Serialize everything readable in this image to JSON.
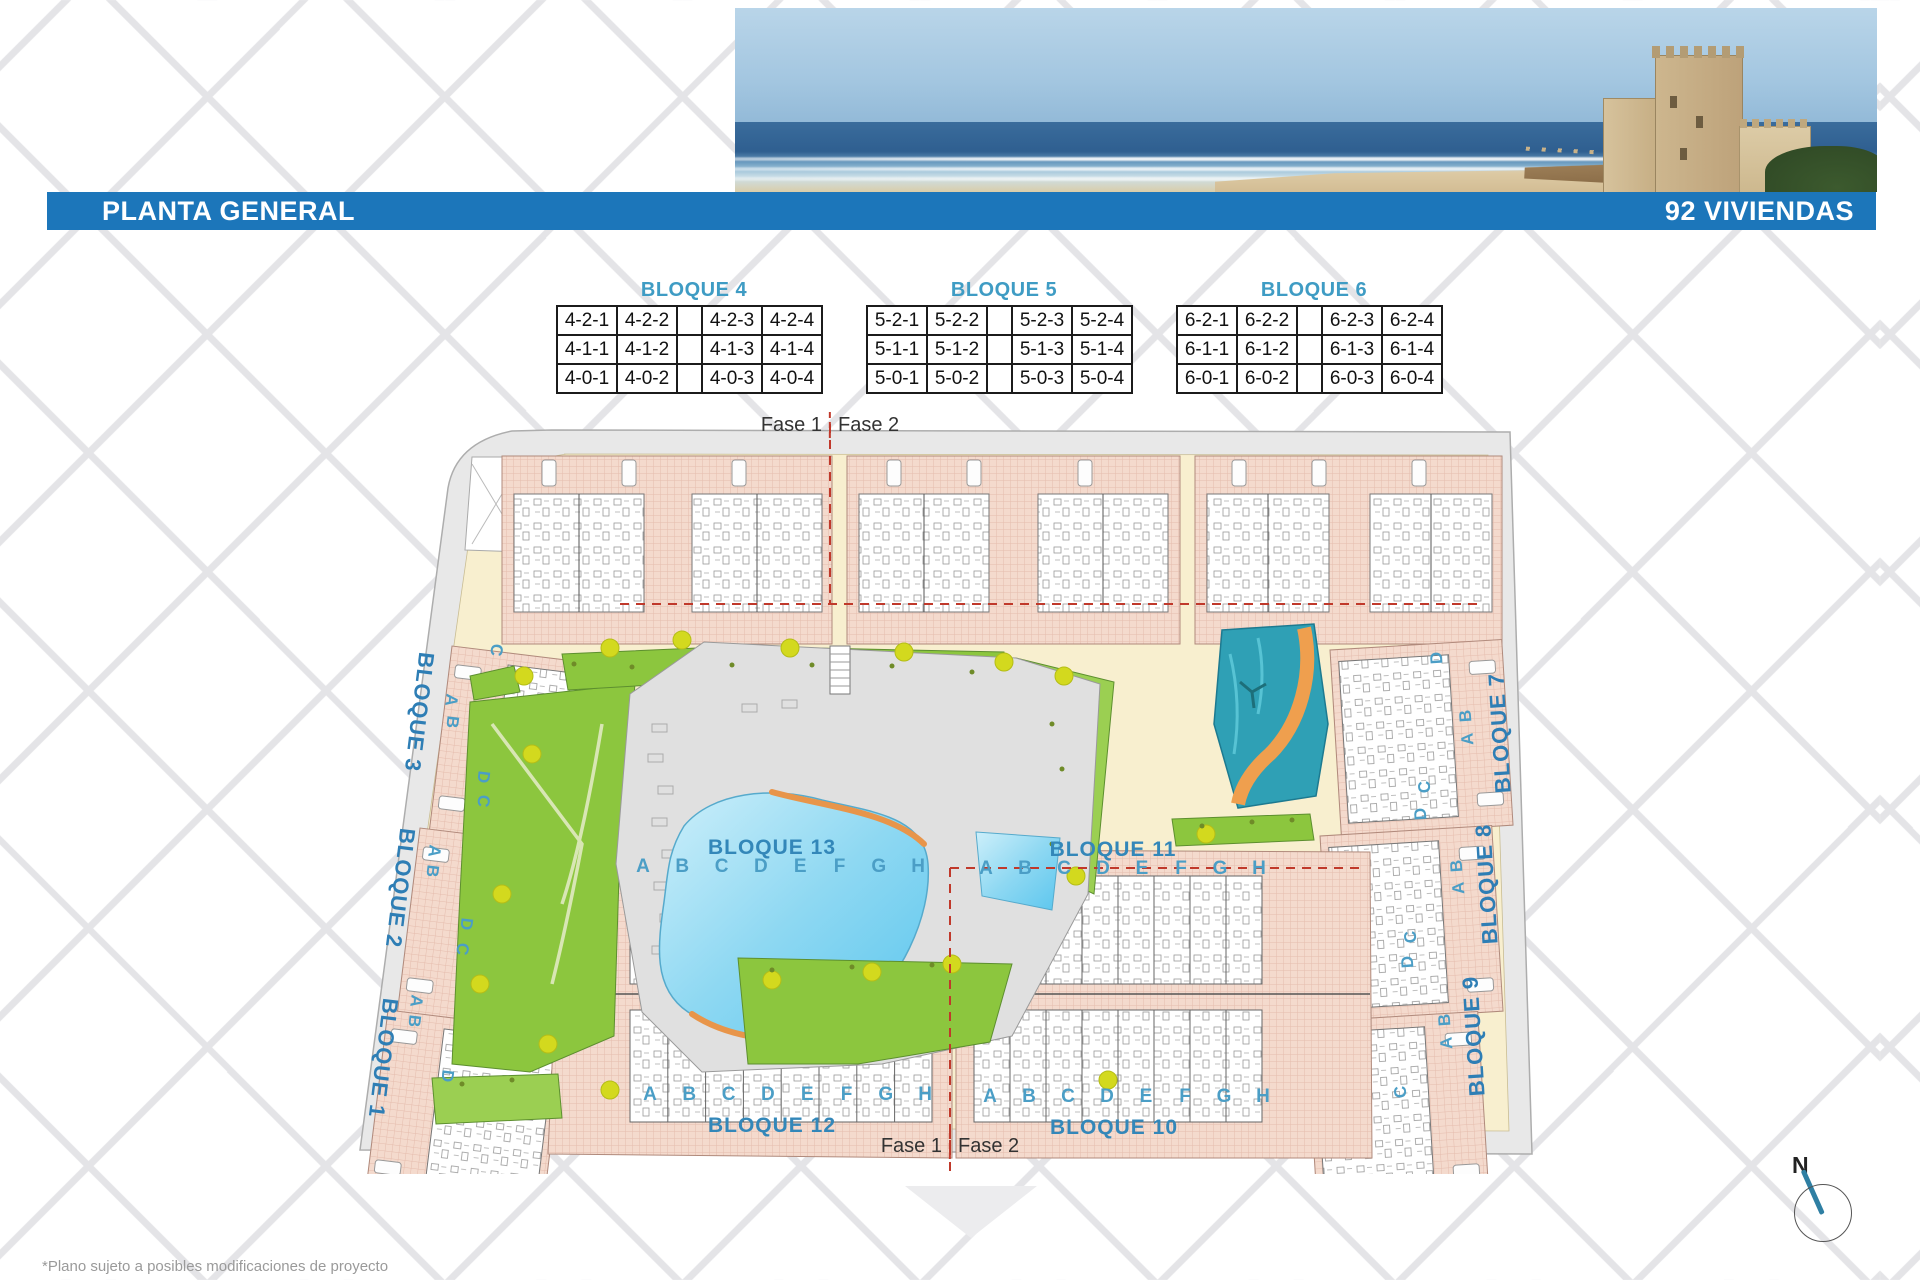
{
  "banner": {
    "title": "PLANTA GENERAL",
    "right": "92 VIVIENDAS"
  },
  "unit_tables": [
    {
      "title": "BLOQUE 4",
      "rows": [
        [
          "4-2-1",
          "4-2-2",
          "4-2-3",
          "4-2-4"
        ],
        [
          "4-1-1",
          "4-1-2",
          "4-1-3",
          "4-1-4"
        ],
        [
          "4-0-1",
          "4-0-2",
          "4-0-3",
          "4-0-4"
        ]
      ]
    },
    {
      "title": "BLOQUE 5",
      "rows": [
        [
          "5-2-1",
          "5-2-2",
          "5-2-3",
          "5-2-4"
        ],
        [
          "5-1-1",
          "5-1-2",
          "5-1-3",
          "5-1-4"
        ],
        [
          "5-0-1",
          "5-0-2",
          "5-0-3",
          "5-0-4"
        ]
      ]
    },
    {
      "title": "BLOQUE 6",
      "rows": [
        [
          "6-2-1",
          "6-2-2",
          "6-2-3",
          "6-2-4"
        ],
        [
          "6-1-1",
          "6-1-2",
          "6-1-3",
          "6-1-4"
        ],
        [
          "6-0-1",
          "6-0-2",
          "6-0-3",
          "6-0-4"
        ]
      ]
    }
  ],
  "phase_labels": {
    "fase1": "Fase 1",
    "fase2": "Fase 2"
  },
  "plan": {
    "block_titles": {
      "b13": "BLOQUE 13",
      "b11": "BLOQUE 11",
      "b12": "BLOQUE 12",
      "b10": "BLOQUE 10"
    },
    "row_letters": [
      "A",
      "B",
      "C",
      "D",
      "E",
      "F",
      "G",
      "H"
    ],
    "side_blocks_left": [
      "BLOQUE 3",
      "BLOQUE 2",
      "BLOQUE 1"
    ],
    "side_blocks_right": [
      "BLOQUE 7",
      "BLOQUE 8",
      "BLOQUE 9"
    ],
    "side_letters_left": [
      "C",
      "A",
      "B",
      "D",
      "C",
      "A",
      "B",
      "D",
      "C",
      "A",
      "B",
      "D"
    ],
    "side_letters_right": [
      "D",
      "B",
      "A",
      "C",
      "D",
      "B",
      "A",
      "C",
      "D",
      "B",
      "A",
      "C"
    ]
  },
  "compass": {
    "north": "N"
  },
  "footnote": "*Plano sujeto a posibles modificaciones de proyecto",
  "colors": {
    "banner_blue": "#1c76ba",
    "table_title_blue": "#3f9cc4",
    "plan_label_blue": "#2e7eb5",
    "phase_line_red": "#c0392b",
    "building_pink": "#f4dacd",
    "path_cream": "#f8efcf",
    "garden_green": "#8cc63e",
    "pool_blue": "#5bc6ee",
    "river_teal": "#2fa0b5",
    "river_orange": "#ef9f4e",
    "road_gray": "#e8e8e8"
  }
}
